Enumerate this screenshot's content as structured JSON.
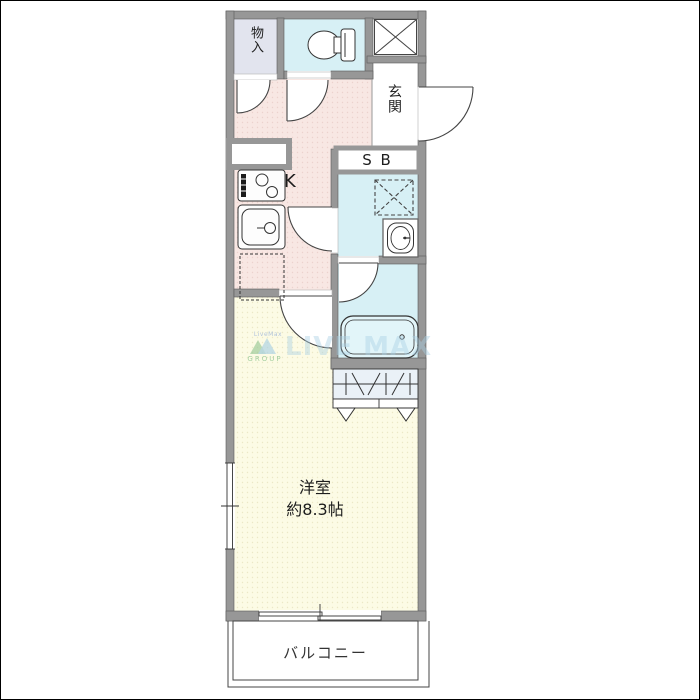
{
  "labels": {
    "storage": "物入",
    "entrance": "玄関",
    "shoe_box": "S B",
    "kitchen": "K",
    "room_name": "洋室",
    "room_size": "約8.3帖",
    "balcony": "バルコニー"
  },
  "watermark": {
    "small_text": "LiveMax",
    "group_text": "GROUP",
    "main_text": "LIVE MAX"
  },
  "colors": {
    "wall": "#979797",
    "kitchen-floor": "#f8e7e3",
    "kitchen-dot": "#ecd2cd",
    "room-floor": "#fcfbe5",
    "room-dot": "#ebe8c6",
    "wet-floor": "#d7f0f5",
    "tub-floor": "#e2f5f9",
    "storage-floor": "#e2e4ee",
    "closet-floor": "#eaf1f7",
    "line": "#3a3a3a",
    "watermark-blue": "#a9cfe3",
    "watermark-green": "#8fc48f"
  }
}
